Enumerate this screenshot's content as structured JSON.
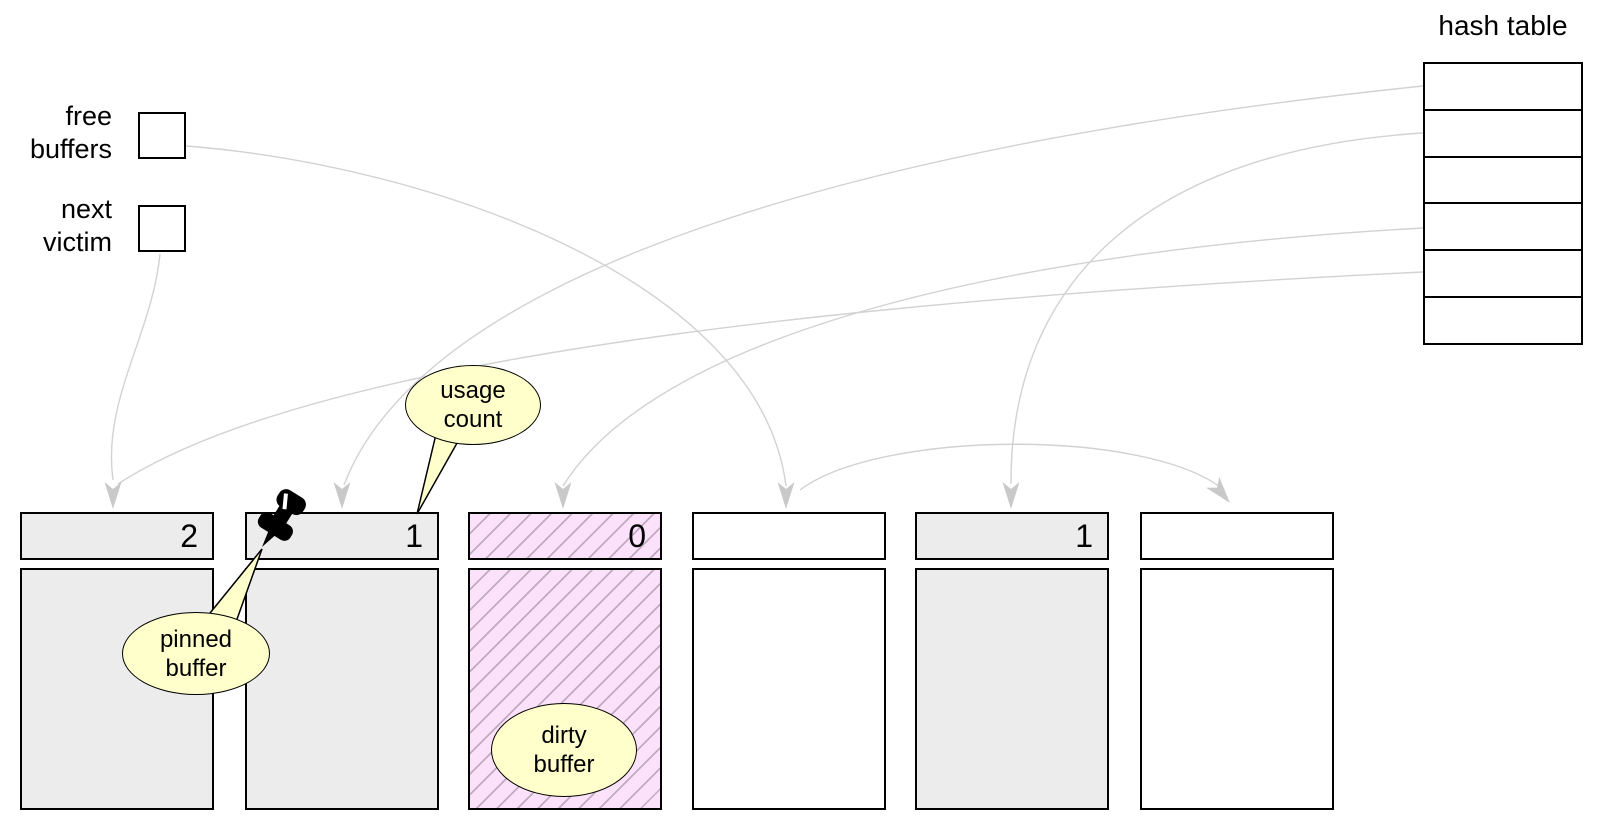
{
  "diagram": {
    "hash_table": {
      "title": "hash table",
      "row_count": 6,
      "rows": [
        "",
        "",
        "",
        "",
        "",
        ""
      ],
      "linked_rows": [
        1,
        2,
        4,
        5
      ]
    },
    "free_list": {
      "label": "free buffers"
    },
    "next_victim": {
      "label": "next victim"
    },
    "buffers": [
      {
        "id": 1,
        "usage_count": "2",
        "state": "in-use"
      },
      {
        "id": 2,
        "usage_count": "1",
        "state": "pinned"
      },
      {
        "id": 3,
        "usage_count": "0",
        "state": "dirty"
      },
      {
        "id": 4,
        "usage_count": "",
        "state": "free"
      },
      {
        "id": 5,
        "usage_count": "1",
        "state": "in-use"
      },
      {
        "id": 6,
        "usage_count": "",
        "state": "free"
      }
    ],
    "callouts": {
      "usage_count": "usage count",
      "pinned_buffer": "pinned buffer",
      "dirty_buffer": "dirty buffer"
    }
  },
  "colors": {
    "buffer_fill": "#ececec",
    "free_fill": "#ffffff",
    "dirty_fill": "#fce1fb",
    "dirty_hatch": "#bfaabf",
    "callout_fill": "#ffffcc",
    "curve": "#d2d2d2",
    "arrow": "#c9c9c9",
    "border": "#000000",
    "pin": "#000000"
  }
}
